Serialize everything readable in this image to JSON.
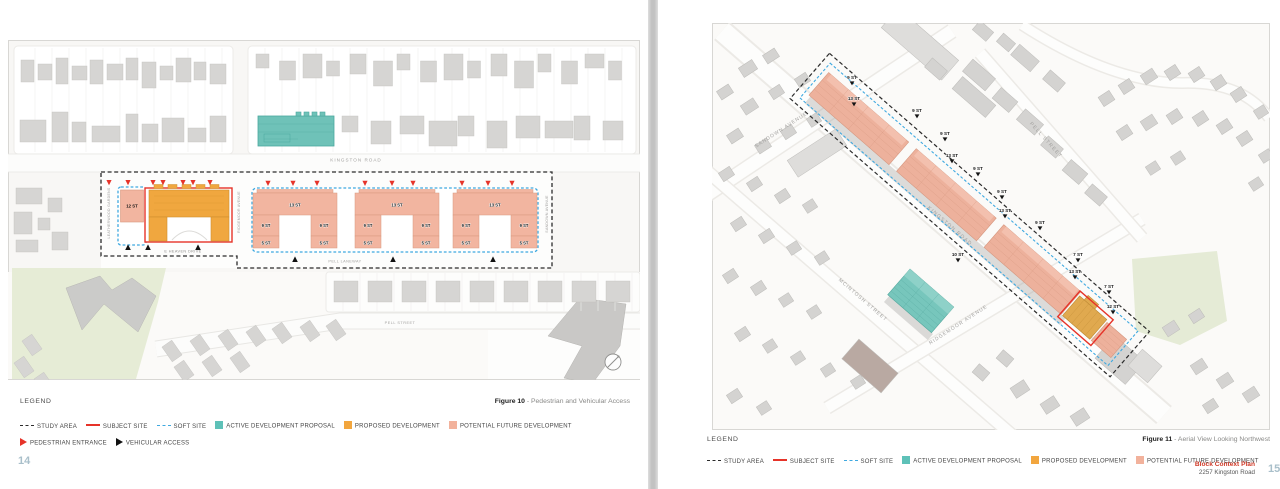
{
  "colors": {
    "study_area": "#2b2b2b",
    "subject_site": "#e63329",
    "soft_site": "#3fa9e0",
    "active_development_proposal": "#5ec1b8",
    "proposed_development": "#f2a63e",
    "potential_future_development": "#f2b29c",
    "park_green": "#e6ecd6",
    "page_number": "#a9bfca",
    "footer_accent": "#d03a28"
  },
  "left_page": {
    "figure_caption": {
      "label": "Figure 10",
      "text": " - Pedestrian and Vehicular Access"
    },
    "page_number": "14",
    "legend": {
      "title": "LEGEND",
      "row1": [
        {
          "symbol": "dash-black",
          "label": "STUDY AREA"
        },
        {
          "symbol": "line-red",
          "label": "SUBJECT SITE"
        },
        {
          "symbol": "dash-blue",
          "label": "SOFT SITE"
        },
        {
          "symbol": "square-teal",
          "label": "ACTIVE DEVELOPMENT PROPOSAL"
        },
        {
          "symbol": "square-orange",
          "label": "PROPOSED DEVELOPMENT"
        },
        {
          "symbol": "square-salmon",
          "label": "POTENTIAL FUTURE DEVELOPMENT"
        }
      ],
      "row2": [
        {
          "symbol": "tri-red",
          "label": "PEDESTRIAN ENTRANCE"
        },
        {
          "symbol": "tri-black",
          "label": "VEHICULAR ACCESS"
        }
      ]
    },
    "map": {
      "streets": {
        "kingston_road": "KINGSTON ROAD",
        "leatherwood_gardens": "LEATHERWOOD GARDENS",
        "ridgemoor_avenue": "RIDGEMOOR AVENUE",
        "sandown_avenue": "SANDOWN AVENUE",
        "e_heaven_drive": "E HEAVEN DRIVE",
        "pell_laneway": "PELL LANEWAY",
        "pell_street": "PELL STREET"
      },
      "buildings": {
        "soft_site_block": "12 ST",
        "u_top": "13 ST",
        "u_wing": "9 ST",
        "u_base": "5 ST"
      }
    }
  },
  "right_page": {
    "figure_caption": {
      "label": "Figure 11",
      "text": " - Aerial View Looking Northwest"
    },
    "page_number": "15",
    "footer": {
      "title": "Block Context Plan",
      "address": "2257 Kingston Road"
    },
    "legend": {
      "title": "LEGEND",
      "row1": [
        {
          "symbol": "dash-black",
          "label": "STUDY AREA"
        },
        {
          "symbol": "line-red",
          "label": "SUBJECT SITE"
        },
        {
          "symbol": "dash-blue",
          "label": "SOFT SITE"
        },
        {
          "symbol": "square-teal",
          "label": "ACTIVE DEVELOPMENT PROPOSAL"
        },
        {
          "symbol": "square-orange",
          "label": "PROPOSED DEVELOPMENT"
        },
        {
          "symbol": "square-salmon",
          "label": "POTENTIAL FUTURE DEVELOPMENT"
        }
      ]
    },
    "map": {
      "streets": {
        "kingston_road": "KINGSTON ROAD",
        "pell_street": "PELL STREET",
        "sandown_avenue": "SANDOWN AVENUE",
        "mcintosh_street": "MCINTOSH STREET",
        "ridgemoor_avenue": "RIDGEMOOR AVENUE"
      },
      "tower_labels": [
        "9 ST",
        "13 ST",
        "9 ST",
        "9 ST",
        "13 ST",
        "9 ST",
        "9 ST",
        "13 ST",
        "9 ST",
        "7 ST",
        "13 ST",
        "7 ST",
        "12 ST",
        "10 ST"
      ]
    }
  }
}
